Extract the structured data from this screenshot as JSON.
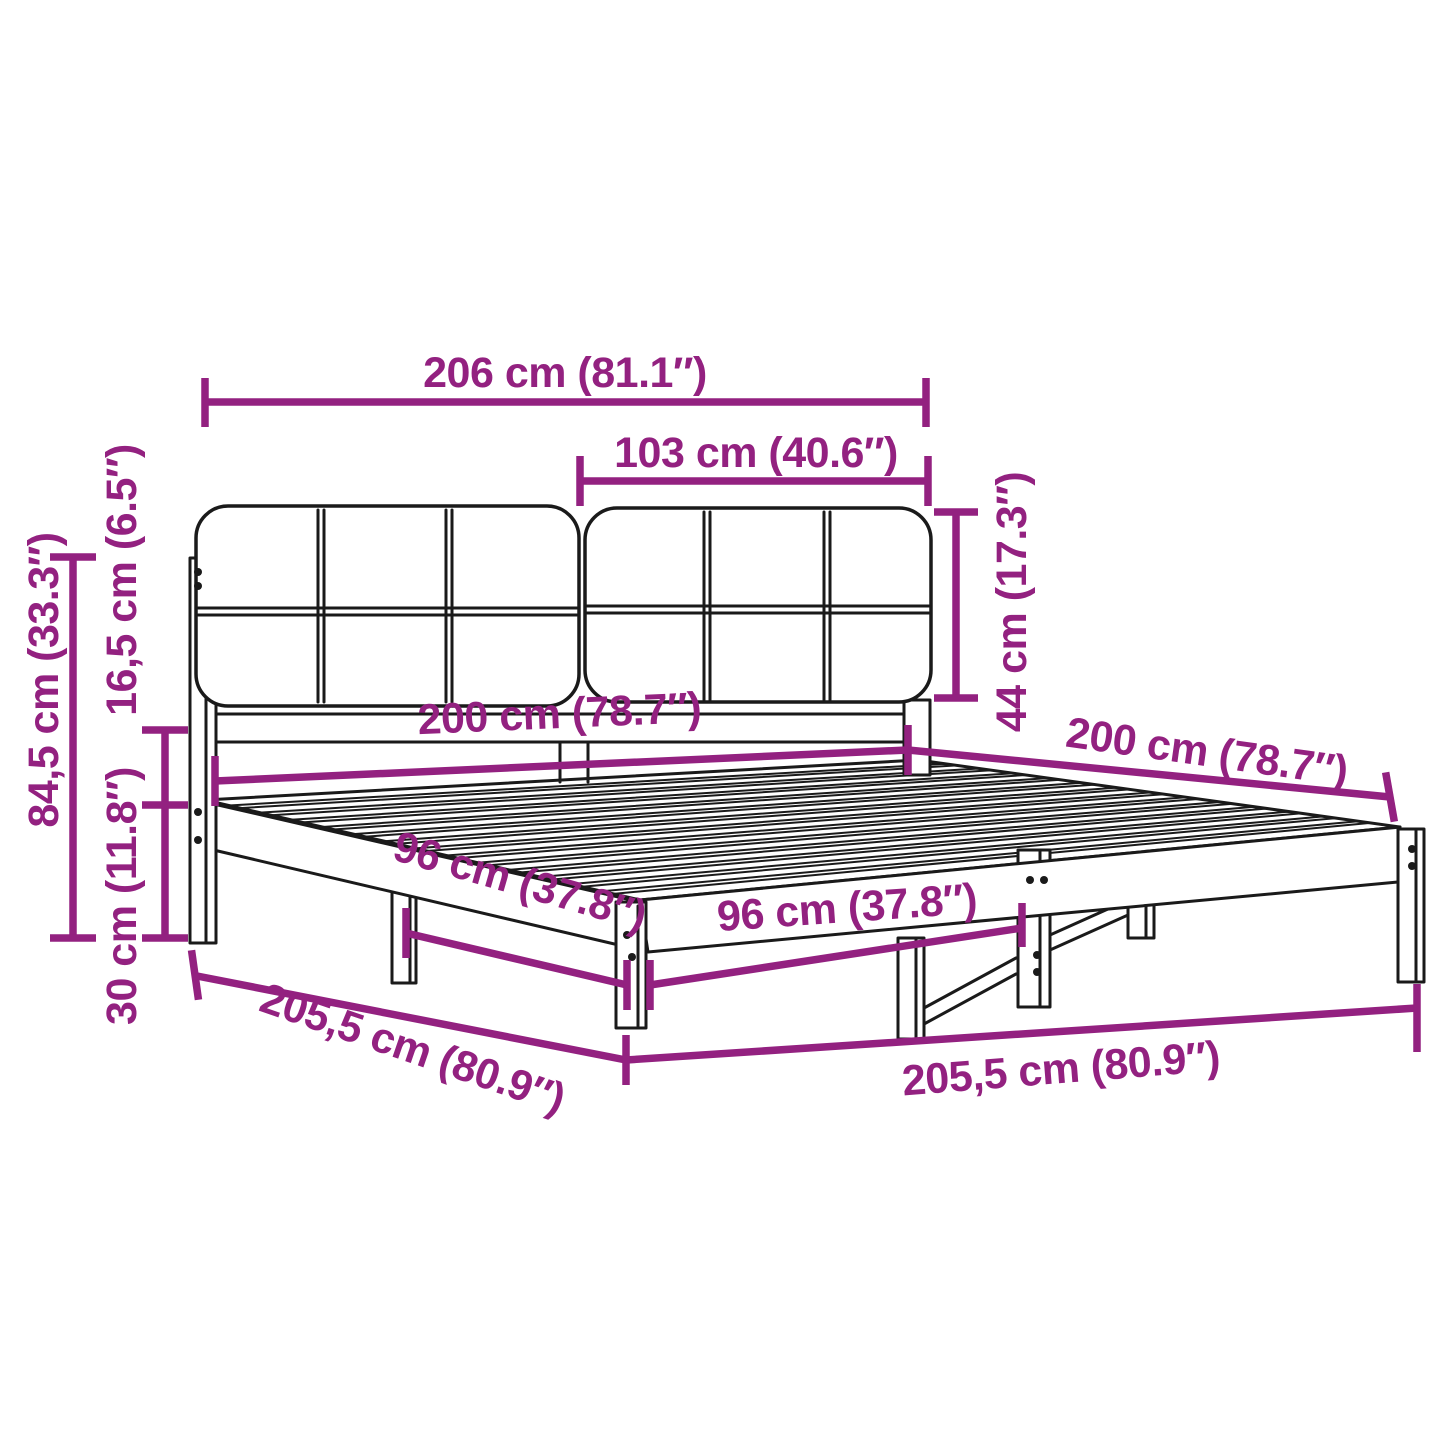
{
  "diagram": {
    "type": "product-dimension-diagram",
    "subject": "bed-frame-with-upholstered-headboard",
    "background": "#ffffff",
    "dimension_color": "#932180",
    "outline_color": "#1a1a1a",
    "labels": {
      "total_width": "206 cm (81.1″)",
      "half_width": "103 cm (40.6″)",
      "headboard_cushion_height": "44 cm (17.3″)",
      "overall_height": "84,5 cm (33.3″)",
      "cushion_above_frame": "16,5 cm (6.5″)",
      "frame_height": "30 cm (11.8″)",
      "mattress_width": "200 cm (78.7″)",
      "mattress_length": "200 cm (78.7″)",
      "leg_span_side": "96 cm (37.8″)",
      "leg_span_front": "96 cm (37.8″)",
      "base_length_side": "205,5 cm (80.9″)",
      "base_length_front": "205,5 cm (80.9″)"
    }
  }
}
